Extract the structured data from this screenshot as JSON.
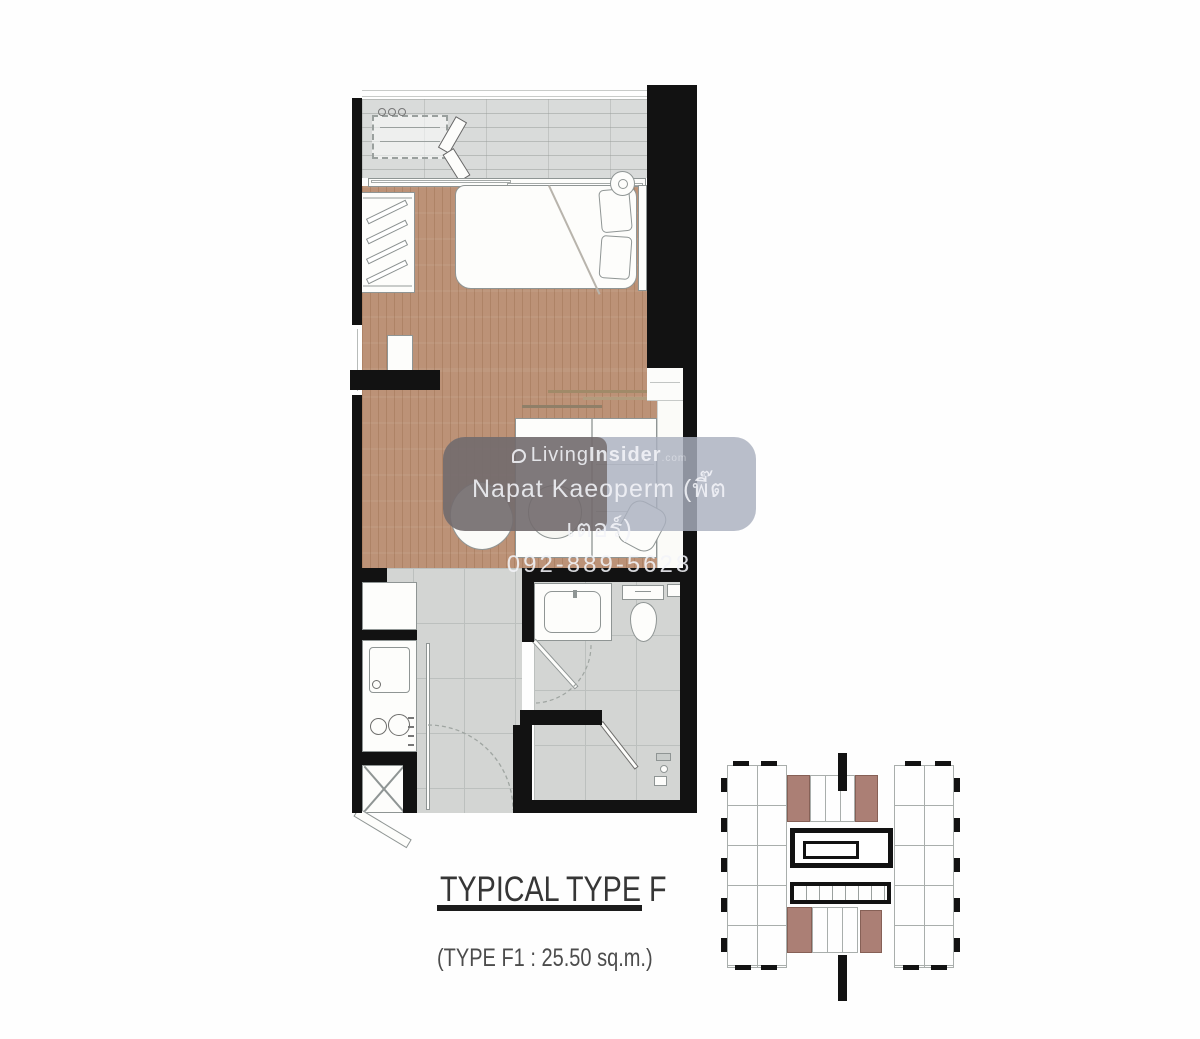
{
  "watermark": {
    "brand_word_1": "Living",
    "brand_word_2": "Insider",
    "brand_suffix": ".com",
    "agent_name": "Napat Kaeoperm (พี๊ตเตอร์)",
    "agent_phone": "092-889-5628"
  },
  "caption": {
    "title": "TYPICAL TYPE F",
    "subtitle": "(TYPE F1 : 25.50 sq.m.)"
  },
  "colors": {
    "wall": "#121212",
    "wood": "#bc9277",
    "wood_line": "rgba(125,78,42,0.22)",
    "balcony_floor": "#d9dbda",
    "tile_floor": "#d3d5d3",
    "tile_line": "#bcc0be",
    "furniture_fill": "#fdfdfb",
    "furniture_outline": "#8f9594",
    "keyplan_unit": "#a4756a",
    "keyplan_line": "#a9aeac",
    "wm_band": "rgba(170,176,190,0.82)",
    "wm_dark": "rgba(70,52,44,0.50)",
    "wm_text": "rgba(243,244,248,0.88)",
    "title_color": "#363636"
  }
}
